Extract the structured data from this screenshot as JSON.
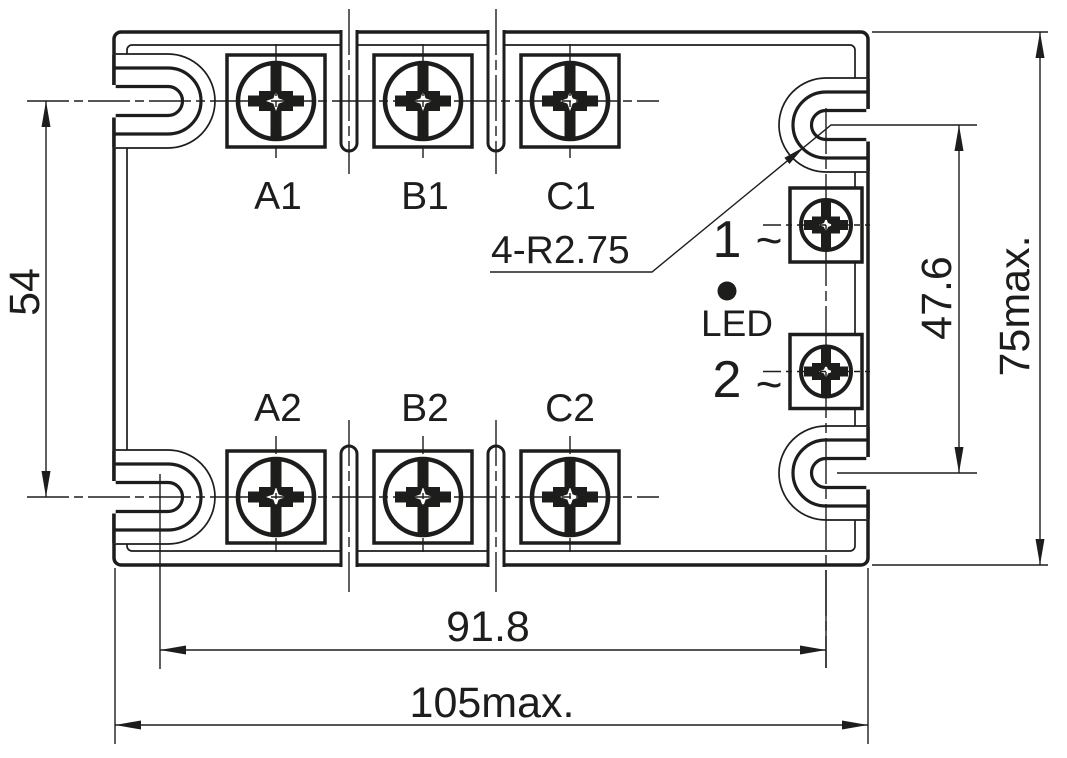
{
  "component": {
    "terminal_labels": {
      "a1": "A1",
      "b1": "B1",
      "c1": "C1",
      "a2": "A2",
      "b2": "B2",
      "c2": "C2"
    },
    "control_terminals": {
      "t1": "1",
      "t1_sign": "~",
      "t2": "2",
      "t2_sign": "~"
    },
    "led_label": "LED",
    "corner_radius_note": "4-R2.75"
  },
  "dimensions": {
    "terminal_row_spacing": "54",
    "control_slot_spacing": "47.6",
    "overall_height": "75max.",
    "mounting_slot_spacing": "91.8",
    "overall_width": "105max."
  },
  "colors": {
    "line": "#1d1d1b",
    "background": "#ffffff"
  }
}
